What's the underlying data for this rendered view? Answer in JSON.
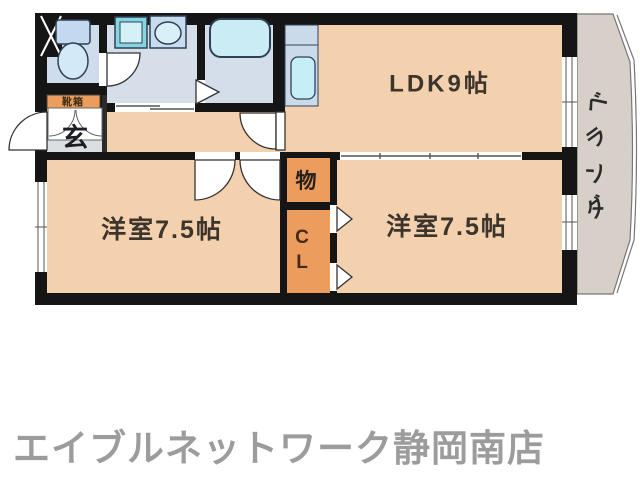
{
  "floorplan": {
    "labels": {
      "ldk": "LDK9帖",
      "bedroom_left": "洋室7.5帖",
      "bedroom_right": "洋室7.5帖",
      "storage": "物",
      "closet_line1": "C",
      "closet_line2": "L",
      "entrance": "玄",
      "shoe_cabinet": "靴箱"
    },
    "veranda": {
      "chars": [
        "ベ",
        "ラ",
        "ン",
        "ダ"
      ]
    },
    "colors": {
      "room_floor": "#f3d0ae",
      "closet_orange": "#ec9c5d",
      "wet_area_floor": "#d6dfe9",
      "wc_floor": "#cfdcec",
      "bath_floor": "#d3deea",
      "entrance_floor": "#dcdfe2",
      "veranda_floor": "#d6d0c9",
      "kitchen_counter": "#cadaeb",
      "fixture_fill": "#c9ecf5",
      "wall": "#151515"
    }
  },
  "footer": {
    "store_name": "エイブルネットワーク静岡南店"
  }
}
